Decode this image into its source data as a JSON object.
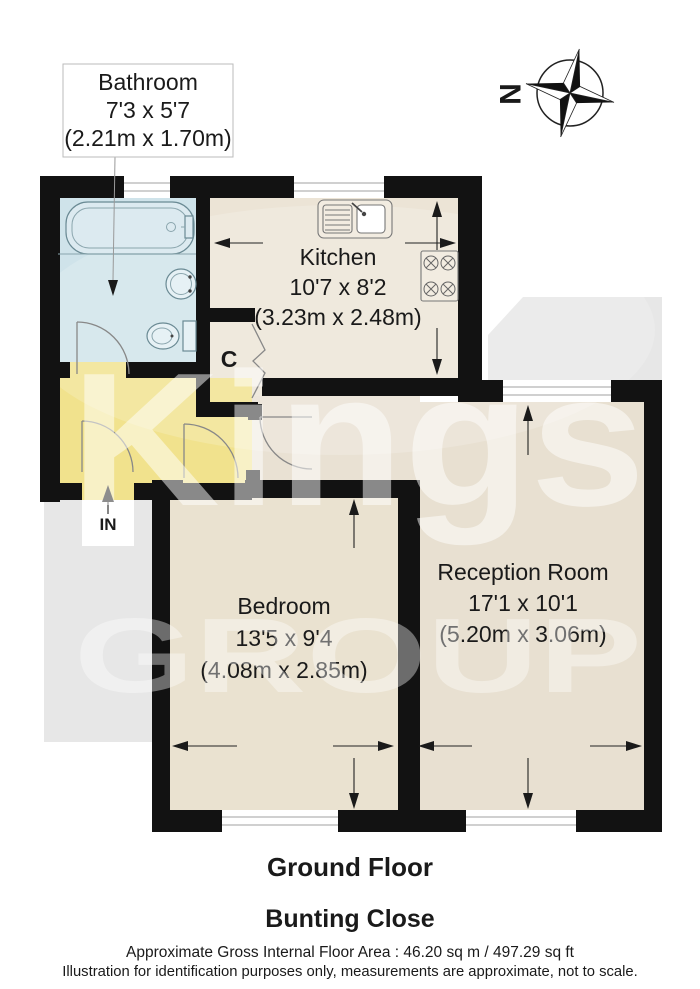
{
  "compass": {
    "north_label": "N"
  },
  "watermark": {
    "line1": "Kings",
    "line2": "GROUP"
  },
  "rooms": {
    "bathroom": {
      "name": "Bathroom",
      "size_imperial": "7'3 x 5'7",
      "size_metric": "(2.21m x 1.70m)"
    },
    "kitchen": {
      "name": "Kitchen",
      "size_imperial": "10'7 x 8'2",
      "size_metric": "(3.23m x 2.48m)"
    },
    "bedroom": {
      "name": "Bedroom",
      "size_imperial": "13'5 x 9'4",
      "size_metric": "(4.08m x 2.85m)"
    },
    "reception": {
      "name": "Reception Room",
      "size_imperial": "17'1 x 10'1",
      "size_metric": "(5.20m x 3.06m)"
    }
  },
  "labels": {
    "cupboard": "C",
    "entrance": "IN"
  },
  "footer": {
    "floor_title": "Ground Floor",
    "address": "Bunting Close",
    "area_line": "Approximate Gross Internal Floor Area : 46.20 sq m / 497.29 sq ft",
    "disclaimer": "Illustration for identification purposes only, measurements are approximate, not to scale."
  },
  "colors": {
    "wall": "#121212",
    "bathroom_floor": "#cfe3ea",
    "kitchen_floor": "#ece4d6",
    "bedroom_floor": "#eae2d0",
    "reception_floor": "#e8e0d1",
    "landing_floor": "#e9e1d3",
    "hallway_floor": "#f1e28d",
    "exterior": "#e7e7e7"
  }
}
